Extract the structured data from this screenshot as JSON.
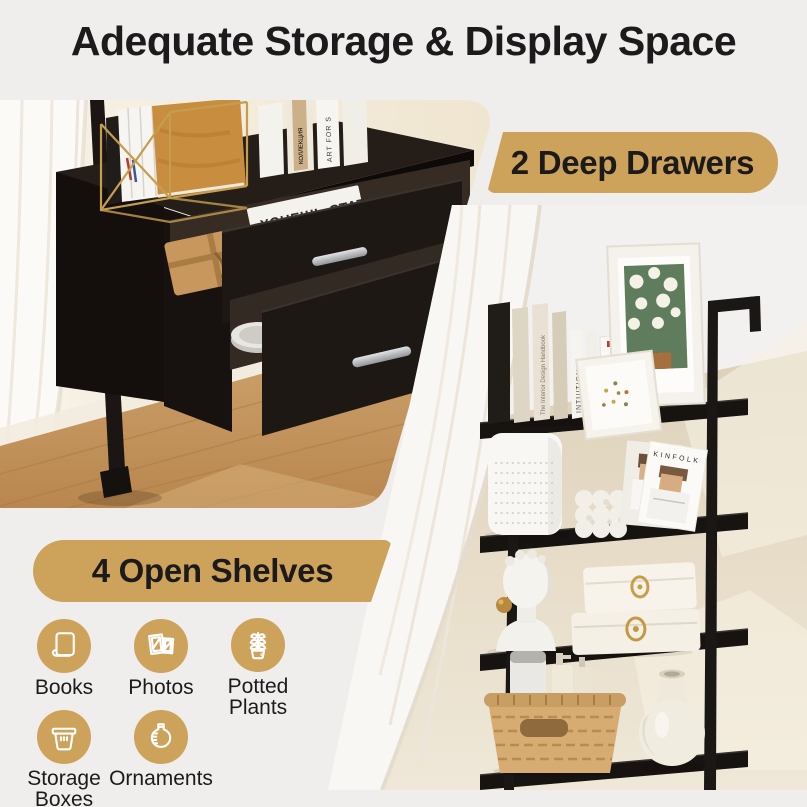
{
  "page": {
    "title": "Adequate Storage & Display Space"
  },
  "badges": {
    "drawers": "2 Deep Drawers",
    "shelves": "4 Open Shelves"
  },
  "features": [
    {
      "label": "Books",
      "lines": [
        "Books"
      ],
      "icon": "book-icon"
    },
    {
      "label": "Photos",
      "lines": [
        "Photos"
      ],
      "icon": "photo-frames-icon"
    },
    {
      "label": "Potted Plants",
      "lines": [
        "Potted",
        "Plants"
      ],
      "icon": "potted-plant-icon"
    },
    {
      "label": "Storage Boxes",
      "lines": [
        "Storage",
        "Boxes"
      ],
      "icon": "storage-basket-icon"
    },
    {
      "label": "Ornaments",
      "lines": [
        "Ornaments"
      ],
      "icon": "ornament-vase-icon"
    }
  ],
  "left_photo": {
    "texts": {
      "magazine_title": "ХОЧЕШЬ СТАТЬ",
      "magazine_subtitle": "ПОП АРТ",
      "book_spine_art": "ART FOR S",
      "book_spine_collection": "КОЛЛЕКЦИЯ"
    }
  },
  "right_photo": {
    "texts": {
      "book_interior": "The Interior Design Handbook",
      "book_intuition": "INTUITION",
      "spine_world": "THE WORLD IN 2020",
      "chart_line1": "THE",
      "chart_line2": "WORLD",
      "chart_line3": "IN 2020",
      "chart_line4": "TRUMPBR",
      "chart_line5": "ERTTLTD",
      "magazine": "KINFOLK"
    }
  },
  "colors": {
    "background": "#efeeed",
    "accent_gold": "#cda35c",
    "text_dark": "#1d1a1b",
    "cabinet_black": "#17120f",
    "wood_floor": "#c89e66",
    "wall_cream": "#f1e8d5",
    "wall_beige": "#ded2bc"
  }
}
